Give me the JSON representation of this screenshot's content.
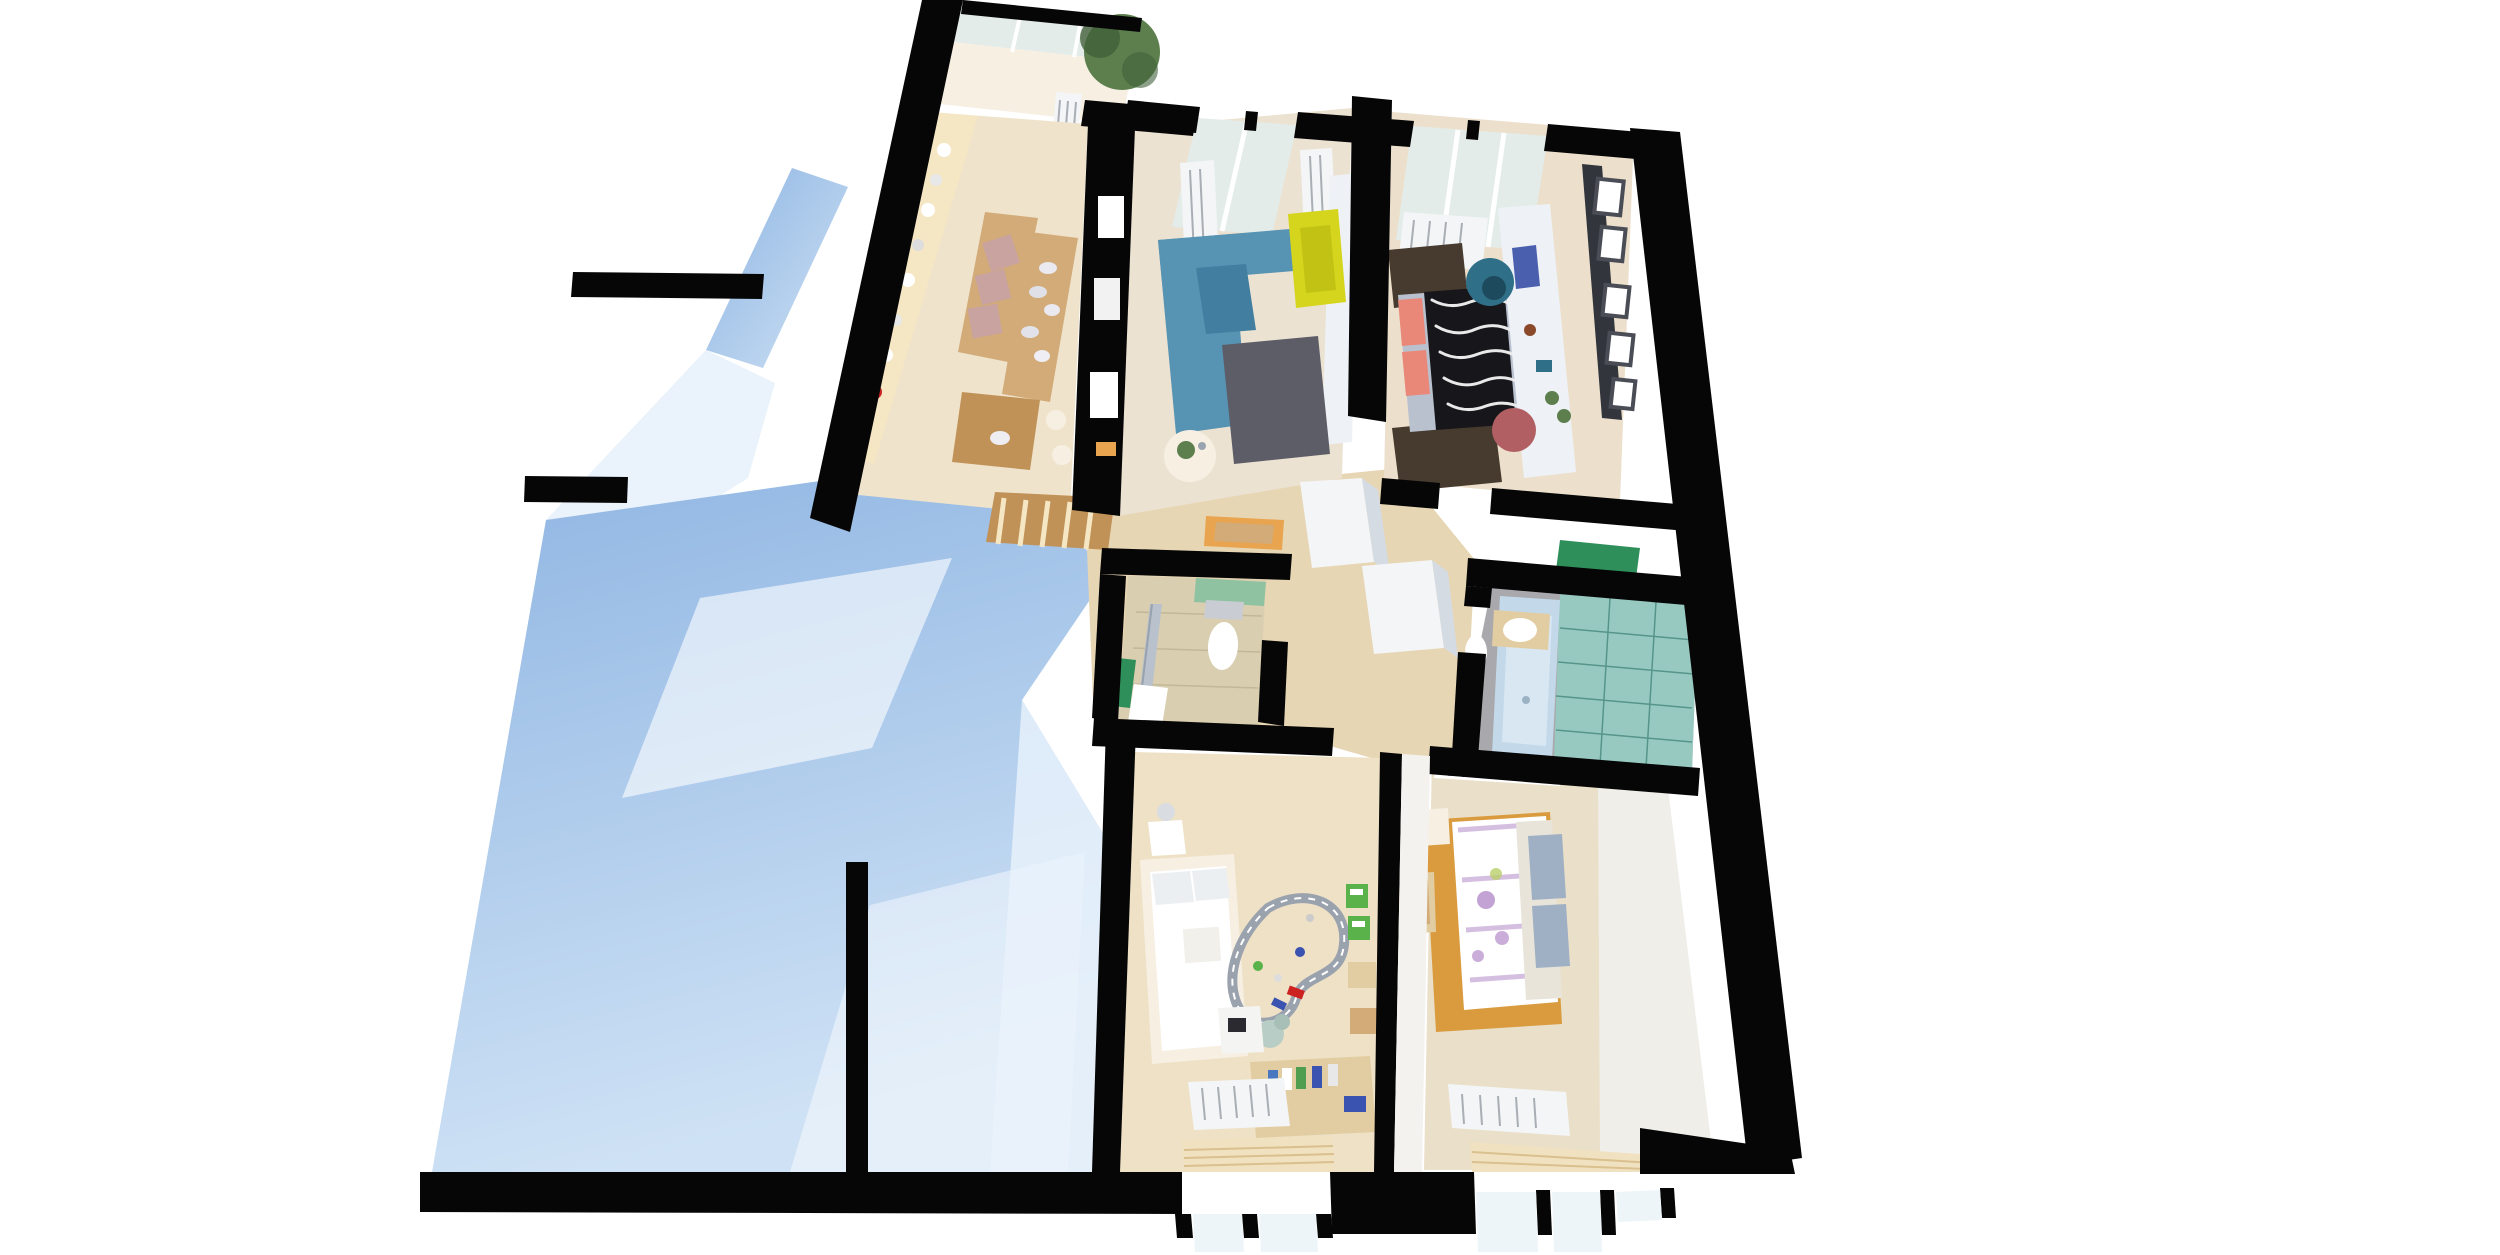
{
  "page": {
    "title_label": ""
  },
  "scene": {
    "kind": "3d-floorplan-cutaway-render",
    "rooms": [
      {
        "id": "balcony",
        "label": "glazed balcony with plant"
      },
      {
        "id": "kitchen",
        "label": "kitchen and dining"
      },
      {
        "id": "living-room",
        "label": "living room"
      },
      {
        "id": "bedroom-top",
        "label": "bedroom with zebra bed and long desk"
      },
      {
        "id": "wc",
        "label": "small wc with shower and toilet"
      },
      {
        "id": "bathroom",
        "label": "bathroom with bathtub and teal tile"
      },
      {
        "id": "hallway",
        "label": "hallway with closets"
      },
      {
        "id": "kids-room",
        "label": "kids room with train track"
      },
      {
        "id": "bedroom-bottom",
        "label": "bedroom with floral bed and orange rug"
      },
      {
        "id": "exterior",
        "label": "light blue exterior wall planes"
      }
    ],
    "colors": {
      "bg": "#ffffff",
      "wall": "#060606",
      "shadow_blue": "#8db4e2",
      "shadow_blue_light": "#cfe2f5",
      "shadow_pale": "#eaf2fb",
      "floor_wood": "#efe3cb",
      "floor_living": "#ece2d2",
      "floor_bed_top": "#ece0cc",
      "floor_kids": "#eee1c6",
      "floor_bed_bottom": "#eadfc8",
      "hall_wood": "#e7d6b4",
      "counter_cream": "#f5e6c4",
      "wood_mid": "#d2ab78",
      "wood_dark": "#c19257",
      "sofa_blue": "#5793b3",
      "sofa_blue_dark": "#417ea0",
      "armchair_yellow": "#d5d51d",
      "rug_gray": "#5d5d67",
      "rug_brown": "#473a2e",
      "rug_orange": "#d99b3e",
      "zebra_dark": "#17171b",
      "zebra_light": "#e9e9e9",
      "pillow_coral": "#e98778",
      "bed_base_gray": "#b9c1cf",
      "desk_white": "#eef2f7",
      "egg_teal": "#2f7088",
      "chair_pink": "#b25f63",
      "shelf_dark": "#32353c",
      "frame_gray": "#4a4d55",
      "radiator_white": "#f3f5f7",
      "radiator_line": "#a9aeb5",
      "glass": "#e3ece8",
      "glass_blue": "#eef5f9",
      "tile_beige": "#d9ceb0",
      "tile_line": "#c2b897",
      "tile_teal": "#98c9c0",
      "tile_teal_line": "#55958a",
      "tub_blue": "#c3d9ea",
      "floor_gray": "#a9a9ad",
      "plank_line": "#8e8e92",
      "green_cabinet": "#2e8f5b",
      "green_wall": "#8fc2a0",
      "green_toy": "#59b24a",
      "orange_nook": "#e9a44f",
      "white": "#ffffff",
      "cream": "#f6efe2",
      "wood_shelf": "#e2cda2",
      "track_gray": "#9aa2ae",
      "plant_green": "#5d7f4e",
      "plant_dark": "#41603a",
      "purple_floral": "#b38cc9",
      "wall_texture": "#efeee9",
      "pillow_gray": "#9fb0c4",
      "cushion_mauve": "#c9a3a0",
      "monitor_blue": "#4a5fae",
      "red_accent": "#cc2222",
      "toy_blue": "#3a52b0",
      "book_blue": "#4a78c0",
      "book_green": "#4f9e4f",
      "blind_tan": "#f0e2c0",
      "blind_line": "#d9c08e"
    }
  }
}
